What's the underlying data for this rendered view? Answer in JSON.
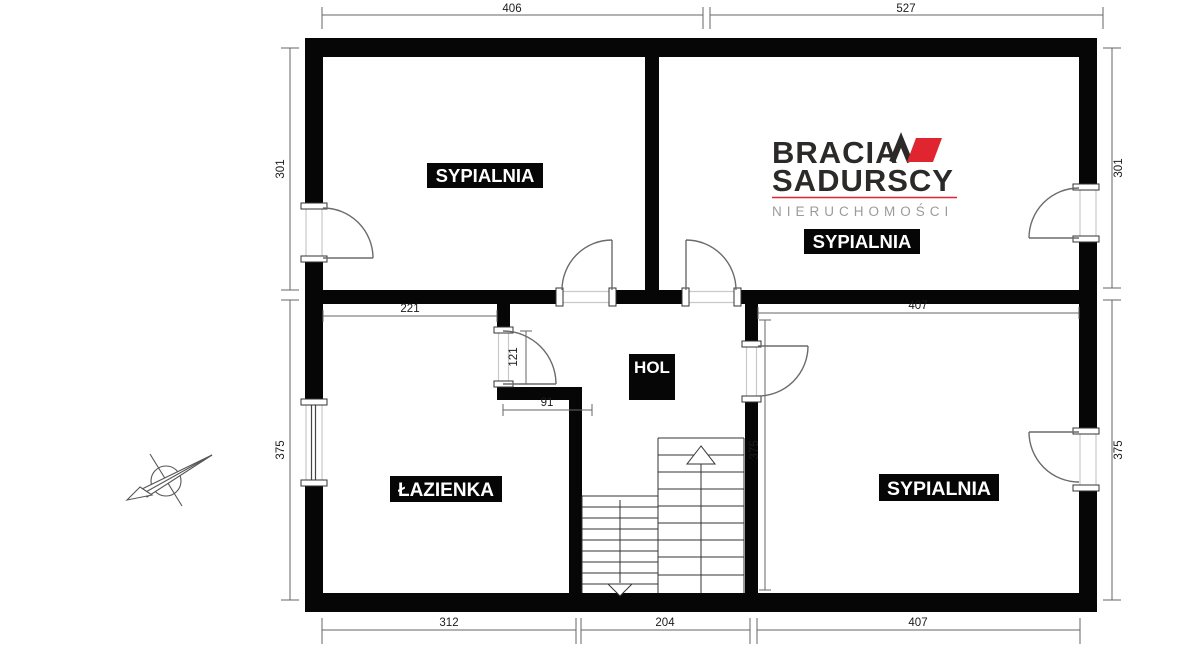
{
  "plan_type": "floor-plan",
  "logo": {
    "brand_line1": "BRACIA",
    "brand_line2": "SADURSCY",
    "tagline": "NIERUCHOMOŚCI"
  },
  "rooms": {
    "bedroom1": "SYPIALNIA",
    "bedroom2": "SYPIALNIA",
    "bedroom3": "SYPIALNIA",
    "bathroom": "ŁAZIENKA",
    "hall": "HOL"
  },
  "dims": {
    "top_406": "406",
    "top_527": "527",
    "left_301": "301",
    "left_375": "375",
    "right_301": "301",
    "right_375": "375",
    "bottom_312": "312",
    "bottom_204": "204",
    "bottom_407": "407",
    "interior_221": "221",
    "interior_121": "121",
    "interior_91": "91",
    "interior_407": "407",
    "interior_375": "375"
  },
  "colors": {
    "wall": "#060606",
    "thin_line": "#666666",
    "face_line": "#c9c9c9",
    "accent_red": "#e02530",
    "logo_dark": "#2b2a29",
    "tagline_gray": "#9b9b9b"
  }
}
